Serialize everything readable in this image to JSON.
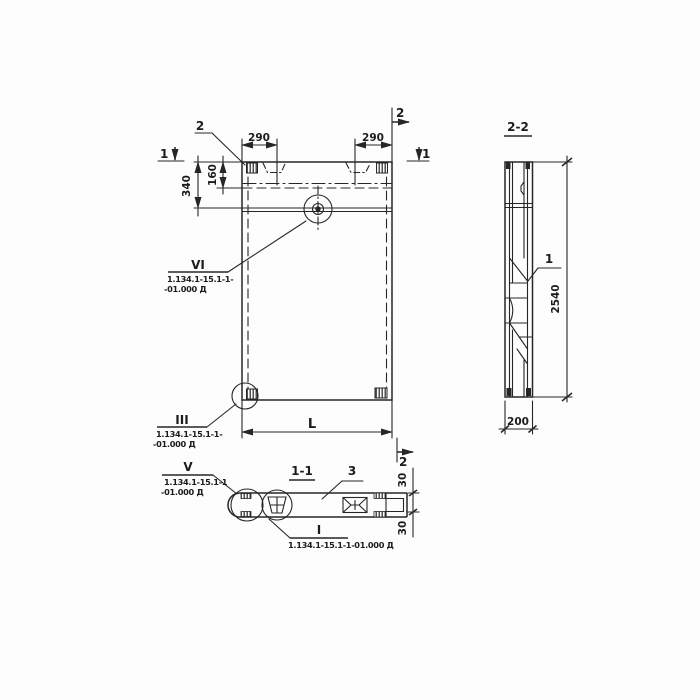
{
  "ink_color": "#262626",
  "elevation": {
    "leader2_label": "2",
    "cut2_top_label": "2",
    "cut2_bottom_label": "2",
    "cut1_left_label": "1",
    "cut1_right_label": "1",
    "dim_290_left": "290",
    "dim_290_right": "290",
    "dim_160": "160",
    "dim_340": "340",
    "dim_L": "L",
    "detail_vi": {
      "numeral": "VI",
      "ref1": "1.134.1-15.1-1-",
      "ref2": "-01.000 Д"
    },
    "detail_iii": {
      "numeral": "III",
      "ref1": "1.134.1-15.1-1-",
      "ref2": "-01.000 Д"
    }
  },
  "section_1_1": {
    "title": "1-1",
    "part_3_label": "3",
    "dim_30_top": "30",
    "dim_30_bottom": "30",
    "detail_v": {
      "numeral": "V",
      "ref1": "1.134.1-15.1-1",
      "ref2": "-01.000 Д"
    },
    "detail_i": {
      "numeral": "I",
      "ref": "1.134.1-15.1-1-01.000 Д"
    }
  },
  "section_2_2": {
    "title": "2-2",
    "part_1_label": "1",
    "dim_2540": "2540",
    "dim_200": "200"
  }
}
